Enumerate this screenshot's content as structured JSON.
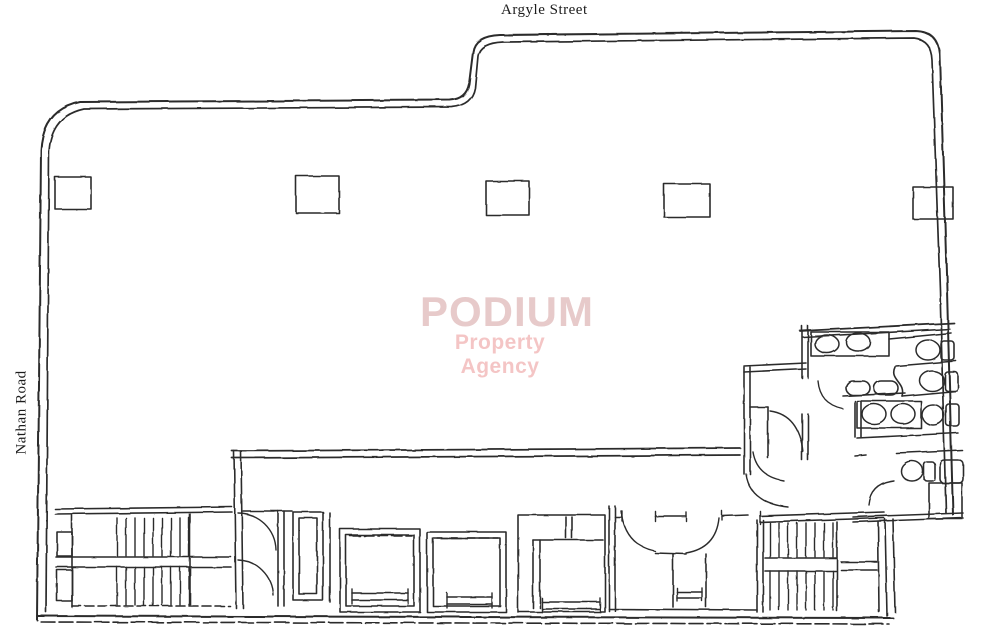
{
  "labels": {
    "street_top": "Argyle Street",
    "road_left": "Nathan Road"
  },
  "watermark": {
    "title": "PODIUM",
    "subtitle": "Property Agency",
    "title_color": "#e7caca",
    "subtitle_color": "#f3bcbc"
  },
  "drawing": {
    "ink": "#1d1d1d",
    "background": "#ffffff",
    "paths": [
      {
        "name": "outline-outer",
        "w": 2,
        "d": "M 37 620 L 41 150 Q 43 110 80 102 L 450 100 Q 466 99 469 84 L 473 52 Q 475 36 500 35 L 916 31 Q 938 32 940 54 L 947 290 L 953 515"
      },
      {
        "name": "outline-inner",
        "w": 1.7,
        "d": "M 46 612 L 49 152 Q 51 116 84 109 L 452 107 Q 472 105 475 88 L 478 56 Q 480 43 503 42 L 914 38 Q 931 40 932 60 L 940 290 L 946 513"
      },
      {
        "name": "outline-bottom-outer",
        "w": 2,
        "d": "M 37 616 L 893 618"
      },
      {
        "name": "outline-bottom-inner",
        "w": 1.6,
        "dash": "14 4",
        "d": "M 41 622 L 889 624"
      },
      {
        "name": "washroom-bottom-wall-1",
        "d": "M 853 517 L 963 513"
      },
      {
        "name": "washroom-bottom-wall-2",
        "d": "M 853 522 L 963 518"
      },
      {
        "name": "bottom-right-wall-1",
        "d": "M 885 519 L 887 616"
      },
      {
        "name": "bottom-right-wall-2",
        "d": "M 893 519 L 895 612"
      },
      {
        "name": "main-corridor-wall-1",
        "w": 1.8,
        "d": "M 232 451 L 740 448"
      },
      {
        "name": "main-corridor-wall-2",
        "w": 1.8,
        "d": "M 232 458 L 740 455"
      },
      {
        "name": "lobby-left-wall-1",
        "d": "M 234 451 L 236 608"
      },
      {
        "name": "lobby-left-wall-2",
        "d": "M 241 451 L 243 608"
      },
      {
        "name": "stair1-block-top-1",
        "d": "M 55 509 L 232 507"
      },
      {
        "name": "stair1-block-top-2",
        "d": "M 55 514 L 232 512"
      },
      {
        "name": "stair1-left-wall",
        "d": "M 72 514 L 72 607"
      },
      {
        "name": "stair1-landing-1",
        "d": "M 56 557 L 231 557"
      },
      {
        "name": "stair1-landing-2",
        "d": "M 56 567 L 231 567"
      },
      {
        "name": "stair1-right-wall",
        "d": "M 190 514 L 190 605"
      },
      {
        "name": "stair1-block-bottom",
        "dash": "9 4",
        "d": "M 72 606 L 230 606"
      },
      {
        "name": "lobby-top-wall",
        "d": "M 243 511 L 292 511"
      },
      {
        "name": "lobby-door-arc-1",
        "w": 1.4,
        "d": "M 238 513 A 38 38 0 0 1 276 550"
      },
      {
        "name": "lobby-door-arc-2",
        "w": 1.4,
        "d": "M 238 560 A 36 36 0 0 1 273 595"
      },
      {
        "name": "lobby-right-wall-1",
        "d": "M 278 511 L 278 606"
      },
      {
        "name": "lobby-right-wall-2",
        "d": "M 284 511 L 284 606"
      },
      {
        "name": "shaft-right-line",
        "d": "M 330 513 L 330 602"
      },
      {
        "name": "rooms-left-wall-1",
        "d": "M 609 506 L 609 611"
      },
      {
        "name": "rooms-left-wall-2",
        "d": "M 615 506 L 615 611"
      },
      {
        "name": "rooms-top-wall-a",
        "d": "M 615 517 L 622 517"
      },
      {
        "name": "rooms-top-wall-b",
        "d": "M 655 516 L 686 516"
      },
      {
        "name": "rooms-top-wall-c",
        "d": "M 722 516 L 748 515"
      },
      {
        "name": "stair2-top-wall-1",
        "d": "M 760 516 L 884 512"
      },
      {
        "name": "stair2-top-wall-2",
        "d": "M 760 522 L 884 518"
      },
      {
        "name": "room-door-arc-1",
        "w": 1.4,
        "d": "M 621 511 Q 625 545 655 551"
      },
      {
        "name": "room-door-arc-2",
        "w": 1.4,
        "d": "M 719 518 Q 716 548 686 553"
      },
      {
        "name": "room-mid-wall",
        "d": "M 655 553 L 686 554"
      },
      {
        "name": "small-room-left-wall",
        "d": "M 673 554 L 673 607"
      },
      {
        "name": "small-room-right-wall",
        "d": "M 706 554 L 706 607"
      },
      {
        "name": "rooms-bottom-wall",
        "d": "M 609 609 L 757 610"
      },
      {
        "name": "stair2-left-wall-1",
        "d": "M 757 520 L 757 612"
      },
      {
        "name": "stair2-left-wall-2",
        "d": "M 763 520 L 763 612"
      },
      {
        "name": "stair2-right-wall",
        "d": "M 837 522 L 837 611"
      },
      {
        "name": "stair2-landing-1",
        "d": "M 765 558 L 836 558"
      },
      {
        "name": "stair2-landing-2",
        "d": "M 765 571 L 836 571"
      },
      {
        "name": "stair2-lobby-line-1",
        "d": "M 841 562 L 877 562"
      },
      {
        "name": "stair2-lobby-line-2",
        "d": "M 841 570 L 877 570"
      },
      {
        "name": "stair2-lobby-wall",
        "d": "M 878 521 L 879 612"
      },
      {
        "name": "corridor-left-wall-1",
        "d": "M 744 367 L 744 474"
      },
      {
        "name": "corridor-left-wall-2",
        "d": "M 750 367 L 750 474"
      },
      {
        "name": "corridor-top-wall-1",
        "d": "M 744 366 L 806 363"
      },
      {
        "name": "corridor-top-wall-2",
        "d": "M 744 372 L 806 369"
      },
      {
        "name": "washroom-left-wall-1a",
        "d": "M 802 326 L 802 378"
      },
      {
        "name": "washroom-left-wall-1b",
        "d": "M 808 326 L 808 378"
      },
      {
        "name": "washroom-left-wall-2a",
        "d": "M 802 414 L 802 460"
      },
      {
        "name": "washroom-left-wall-2b",
        "d": "M 808 414 L 808 460"
      },
      {
        "name": "closet-top-wall",
        "d": "M 750 407 L 768 407"
      },
      {
        "name": "closet-right-wall",
        "d": "M 768 407 L 768 458"
      },
      {
        "name": "closet-door-arc",
        "w": 1.4,
        "d": "M 770 411 Q 799 415 803 452"
      },
      {
        "name": "washroom-door-arc",
        "w": 1.4,
        "d": "M 818 381 Q 820 404 843 409"
      },
      {
        "name": "corridor-bottom-door-arc",
        "w": 1.4,
        "d": "M 746 474 Q 750 503 788 507"
      },
      {
        "name": "corridor-entry-door-arc",
        "w": 1.4,
        "d": "M 753 452 Q 757 476 783 480"
      },
      {
        "name": "washroom-top-wall-1",
        "w": 1.8,
        "d": "M 800 331 L 954 323"
      },
      {
        "name": "washroom-top-wall-2",
        "d": "M 803 337 L 950 329"
      },
      {
        "name": "stall-wall-1",
        "d": "M 889 339 L 951 333"
      },
      {
        "name": "stall-wall-2",
        "d": "M 896 366 L 956 361"
      },
      {
        "name": "stall-curved-wall",
        "d": "M 895 367 C 889 380 906 382 902 396"
      },
      {
        "name": "stall-wall-3",
        "d": "M 902 396 L 957 391"
      },
      {
        "name": "basin-shelf-line",
        "d": "M 843 396 L 905 393"
      },
      {
        "name": "counter2-wall-1",
        "d": "M 855 401 L 855 437"
      },
      {
        "name": "counter2-wall-2",
        "d": "M 861 401 L 861 437"
      },
      {
        "name": "washroom-divider-wall",
        "d": "M 857 438 L 958 433"
      },
      {
        "name": "wc-room-wall-a",
        "d": "M 855 456 L 866 455"
      },
      {
        "name": "wc-room-wall-b",
        "d": "M 896 453 L 962 450"
      },
      {
        "name": "wc-door-arc",
        "w": 1.4,
        "d": "M 869 505 Q 871 484 894 481"
      },
      {
        "name": "lift1-door-line",
        "dash": "10 4",
        "d": "M 350 536 L 412 536"
      },
      {
        "name": "lift2-door-line",
        "dash": "10 4",
        "d": "M 437 538 L 498 538"
      },
      {
        "name": "lift3-top-line",
        "d": "M 533 540 L 603 540"
      },
      {
        "name": "lift3-inner-wall-1",
        "d": "M 533 540 L 533 608"
      },
      {
        "name": "lift3-inner-wall-2",
        "d": "M 540 540 L 540 608"
      },
      {
        "name": "lift3-divider-1",
        "d": "M 566 517 L 566 538"
      },
      {
        "name": "lift3-divider-2",
        "d": "M 572 517 L 572 538"
      },
      {
        "name": "lift1-sill-1",
        "d": "M 352 593 L 408 593"
      },
      {
        "name": "lift1-sill-2",
        "d": "M 352 600 L 408 600"
      },
      {
        "name": "lift2-sill-1",
        "d": "M 447 597 L 492 597"
      },
      {
        "name": "lift2-sill-2",
        "d": "M 447 604 L 492 604"
      },
      {
        "name": "lift3-sill-1",
        "d": "M 542 602 L 600 602"
      },
      {
        "name": "lift3-sill-2",
        "d": "M 542 609 L 600 609"
      },
      {
        "name": "small-room-sill-1",
        "d": "M 677 592 L 702 592"
      },
      {
        "name": "small-room-sill-2",
        "d": "M 677 598 L 702 598"
      }
    ],
    "rects": [
      {
        "name": "column",
        "x": 55,
        "y": 177,
        "w": 36,
        "h": 32
      },
      {
        "name": "column",
        "x": 296,
        "y": 176,
        "w": 43,
        "h": 37
      },
      {
        "name": "column",
        "x": 486,
        "y": 181,
        "w": 43,
        "h": 34
      },
      {
        "name": "column",
        "x": 664,
        "y": 184,
        "w": 46,
        "h": 33
      },
      {
        "name": "column",
        "x": 913,
        "y": 187,
        "w": 40,
        "h": 32
      },
      {
        "name": "duct",
        "x": 57,
        "y": 532,
        "w": 15,
        "h": 24
      },
      {
        "name": "duct",
        "x": 57,
        "y": 570,
        "w": 15,
        "h": 31
      },
      {
        "name": "shaft",
        "x": 293,
        "y": 512,
        "w": 30,
        "h": 88
      },
      {
        "name": "shaft-inner",
        "x": 299,
        "y": 518,
        "w": 18,
        "h": 76
      },
      {
        "name": "lift-car",
        "x": 340,
        "y": 529,
        "w": 80,
        "h": 83
      },
      {
        "name": "lift-car-inner",
        "x": 346,
        "y": 535,
        "w": 68,
        "h": 71
      },
      {
        "name": "lift-car",
        "x": 427,
        "y": 532,
        "w": 79,
        "h": 80
      },
      {
        "name": "lift-car-inner",
        "x": 433,
        "y": 538,
        "w": 67,
        "h": 68
      },
      {
        "name": "lift-car",
        "x": 518,
        "y": 515,
        "w": 87,
        "h": 97
      },
      {
        "name": "sink-counter",
        "x": 811,
        "y": 332,
        "w": 78,
        "h": 24
      },
      {
        "name": "sink-counter",
        "x": 857,
        "y": 401,
        "w": 64,
        "h": 27
      },
      {
        "name": "toilet-tank",
        "x": 941,
        "y": 341,
        "w": 13,
        "h": 19,
        "rx": 3
      },
      {
        "name": "toilet-tank",
        "x": 945,
        "y": 372,
        "w": 13,
        "h": 19,
        "rx": 3
      },
      {
        "name": "toilet-tank",
        "x": 946,
        "y": 404,
        "w": 13,
        "h": 22,
        "rx": 3
      },
      {
        "name": "toilet-tank",
        "x": 924,
        "y": 462,
        "w": 11,
        "h": 19,
        "rx": 3
      },
      {
        "name": "wc-cistern",
        "x": 940,
        "y": 460,
        "w": 23,
        "h": 23,
        "rx": 4
      },
      {
        "name": "duct",
        "x": 929,
        "y": 483,
        "w": 33,
        "h": 36
      },
      {
        "name": "hand-basin",
        "x": 846,
        "y": 381,
        "w": 24,
        "h": 14,
        "rx": 7
      },
      {
        "name": "hand-basin",
        "x": 874,
        "y": 381,
        "w": 24,
        "h": 14,
        "rx": 7
      }
    ],
    "ellipses": [
      {
        "name": "wash-basin",
        "cx": 827,
        "cy": 344,
        "rx": 12,
        "ry": 9
      },
      {
        "name": "wash-basin",
        "cx": 858,
        "cy": 342,
        "rx": 12,
        "ry": 9
      },
      {
        "name": "wash-basin",
        "cx": 874,
        "cy": 414,
        "rx": 12,
        "ry": 10
      },
      {
        "name": "wash-basin",
        "cx": 903,
        "cy": 414,
        "rx": 12,
        "ry": 10
      },
      {
        "name": "toilet-bowl",
        "cx": 928,
        "cy": 350,
        "rx": 12,
        "ry": 10
      },
      {
        "name": "toilet-bowl",
        "cx": 932,
        "cy": 381,
        "rx": 12,
        "ry": 10
      },
      {
        "name": "toilet-bowl",
        "cx": 933,
        "cy": 415,
        "rx": 11,
        "ry": 10
      },
      {
        "name": "toilet-bowl",
        "cx": 912,
        "cy": 471,
        "rx": 11,
        "ry": 10
      }
    ],
    "lines": [
      {
        "name": "lift-sill-tick",
        "x1": 352,
        "y1": 589,
        "x2": 352,
        "y2": 604
      },
      {
        "name": "lift-sill-tick",
        "x1": 408,
        "y1": 589,
        "x2": 408,
        "y2": 604
      },
      {
        "name": "lift-sill-tick",
        "x1": 447,
        "y1": 593,
        "x2": 447,
        "y2": 608
      },
      {
        "name": "lift-sill-tick",
        "x1": 492,
        "y1": 593,
        "x2": 492,
        "y2": 608
      },
      {
        "name": "lift-sill-tick",
        "x1": 542,
        "y1": 598,
        "x2": 542,
        "y2": 612
      },
      {
        "name": "lift-sill-tick",
        "x1": 600,
        "y1": 598,
        "x2": 600,
        "y2": 612
      },
      {
        "name": "sill-tick",
        "x1": 677,
        "y1": 588,
        "x2": 677,
        "y2": 601
      },
      {
        "name": "sill-tick",
        "x1": 702,
        "y1": 588,
        "x2": 702,
        "y2": 601
      },
      {
        "name": "door-jamb-tick",
        "x1": 622,
        "y1": 511,
        "x2": 622,
        "y2": 521
      },
      {
        "name": "door-jamb-tick",
        "x1": 655,
        "y1": 511,
        "x2": 655,
        "y2": 521
      },
      {
        "name": "door-jamb-tick",
        "x1": 686,
        "y1": 512,
        "x2": 686,
        "y2": 521
      },
      {
        "name": "door-jamb-tick",
        "x1": 722,
        "y1": 511,
        "x2": 722,
        "y2": 520
      },
      {
        "name": "door-jamb-tick",
        "x1": 760,
        "y1": 511,
        "x2": 760,
        "y2": 524
      }
    ],
    "stairs": [
      {
        "name": "staircase-left",
        "x1": 117,
        "x2": 189,
        "step": 9,
        "topY": 518,
        "midY1": 556,
        "midY2": 567,
        "botY": 605
      },
      {
        "name": "staircase-right",
        "x1": 770,
        "x2": 833,
        "step": 9,
        "topY": 523,
        "midY1": 557,
        "midY2": 571,
        "botY": 610
      }
    ]
  }
}
